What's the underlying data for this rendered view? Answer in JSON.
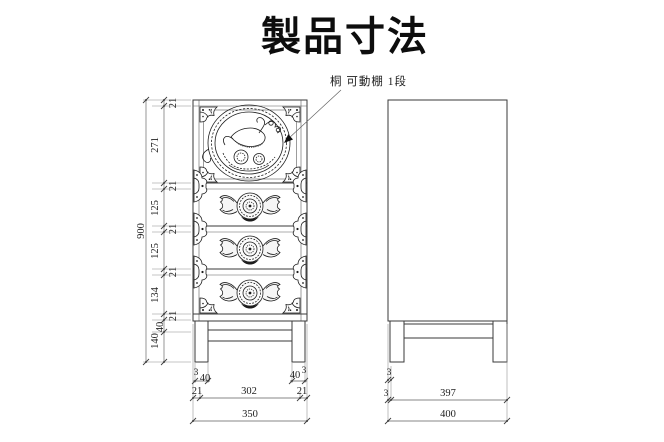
{
  "title": "製品寸法",
  "annotation": {
    "label": "桐 可動棚 1段"
  },
  "colors": {
    "background": "#ffffff",
    "ink": "#1c1c1c",
    "dimension_lines": "#5f5f5f"
  },
  "dims": {
    "h_total": "900",
    "rail_top": "21",
    "seg_top": "271",
    "rail2": "21",
    "seg_d2": "125",
    "rail3": "21",
    "seg_d3": "125",
    "rail4": "21",
    "seg_d4": "134",
    "rail5": "21",
    "stretcher_depth": "40",
    "seg_legs": "140",
    "f_off_l": "3",
    "f_leg_l": "40",
    "f_leg_r": "40",
    "f_off_r": "3",
    "f_post_l": "21",
    "f_inner": "302",
    "f_post_r": "21",
    "f_total": "350",
    "s_leg_off": "3",
    "s_off": "3",
    "s_inner": "397",
    "s_total": "400"
  }
}
